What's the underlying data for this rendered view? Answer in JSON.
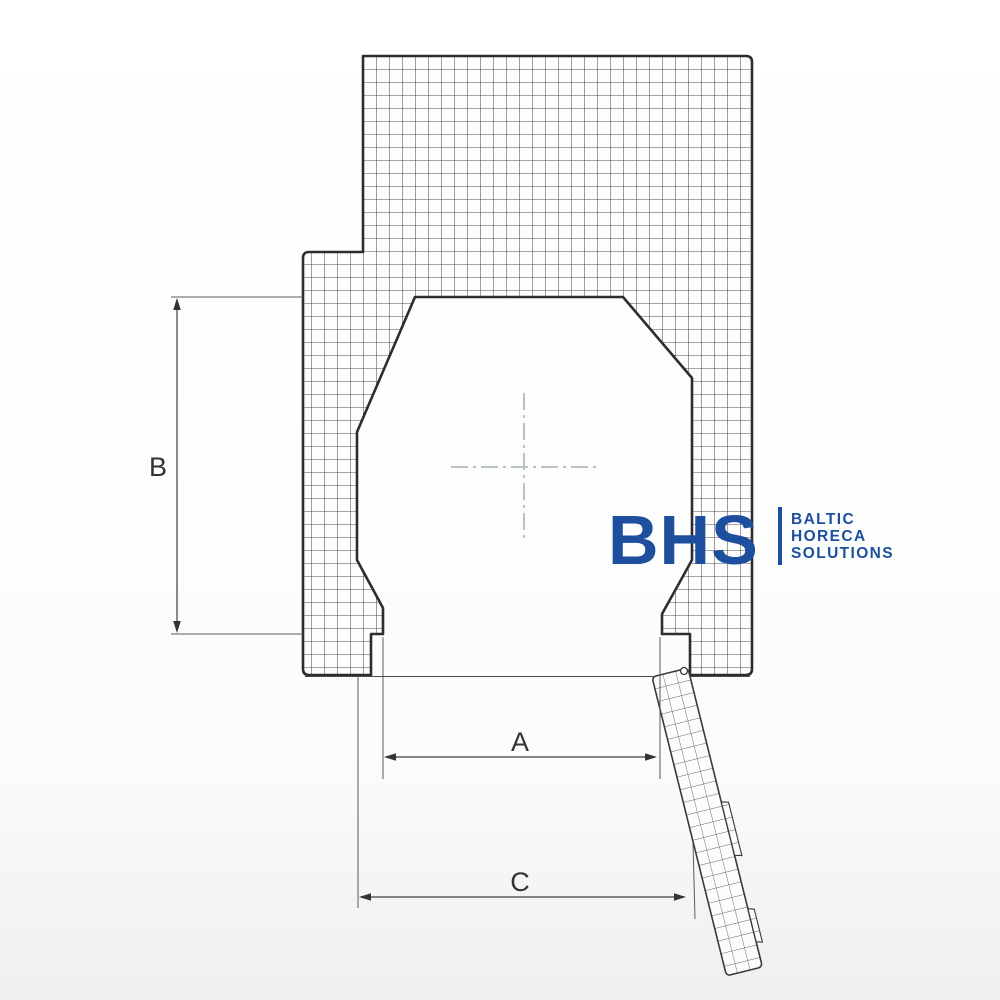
{
  "dimensions": {
    "a_label": "A",
    "b_label": "B",
    "c_label": "C"
  },
  "logo": {
    "abbr": "BHS",
    "name_lines": [
      "BALTIC",
      "HORECA",
      "SOLUTIONS"
    ],
    "brand_color": "#1d4f9e"
  },
  "colors": {
    "outline_dark": "#2d2d2d",
    "grid_line": "#555555",
    "dimension_line": "#3f3f3f",
    "centerline_gray": "#bcc0c4"
  }
}
